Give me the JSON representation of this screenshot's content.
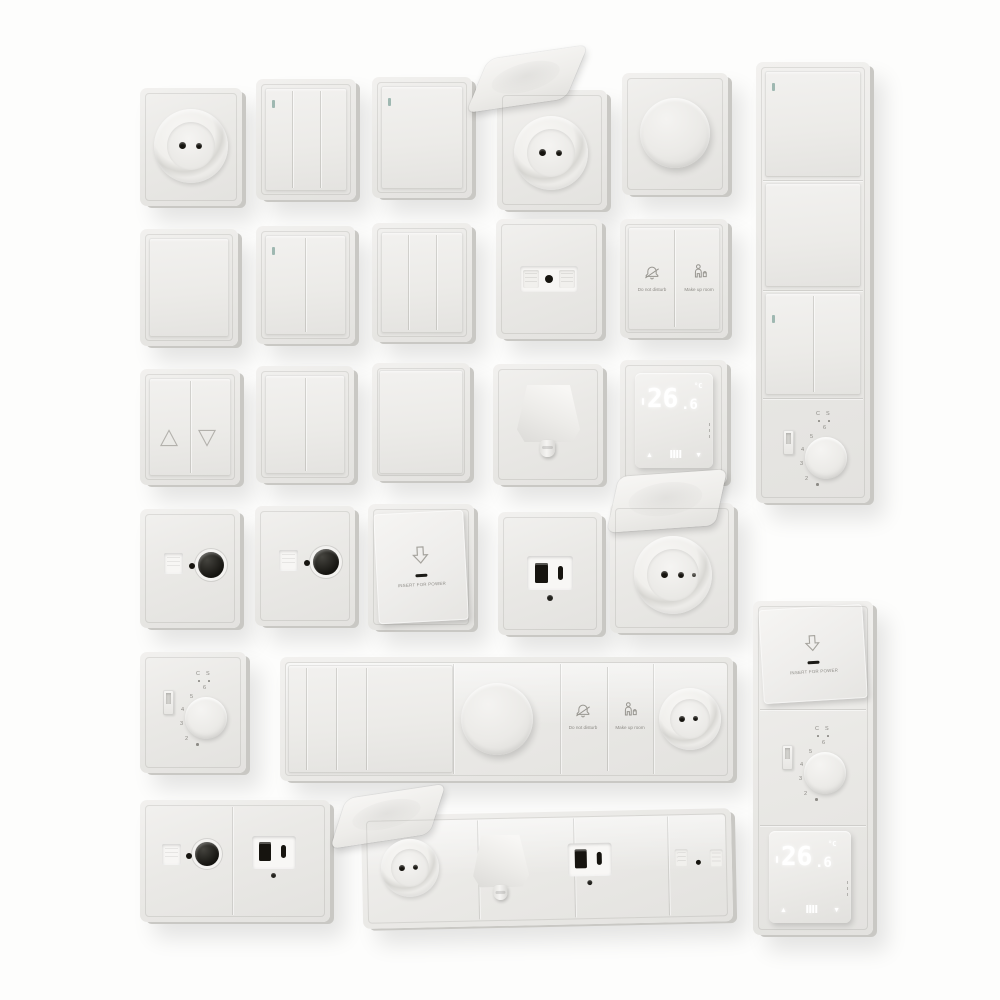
{
  "colors": {
    "page_bg": "#fdfdfc",
    "plate": "#eae9e6",
    "plate_light": "#f3f2f0",
    "plate_edge": "#c9c8c4",
    "icon_stroke": "#97958f",
    "label_text": "#8d8b86",
    "hole_dark": "#16140f",
    "indicator_teal": "#9fb8b1",
    "glow": "#ffffff"
  },
  "icons": {
    "bell_slash": "do-not-disturb bell with slash",
    "housekeeping": "person with cleaning bucket",
    "insert_card": "downward outline arrow",
    "blind_up": "outline triangle up",
    "blind_down": "outline triangle down",
    "menu_grid": "white dot-grid",
    "up_arrow": "▲",
    "down_arrow": "▼"
  },
  "labels": {
    "do_not_disturb": "Do not disturb",
    "make_up_room": "Make up room",
    "insert_for_power": "INSERT FOR POWER",
    "comfort": "C",
    "standby": "S"
  },
  "analog_thermostat": {
    "scale": [
      "6",
      "5",
      "4",
      "3",
      "2"
    ]
  },
  "digital_thermostat": {
    "temperature": "26",
    "decimal": ".6",
    "unit": "°C",
    "up": "▲",
    "down": "▼"
  }
}
